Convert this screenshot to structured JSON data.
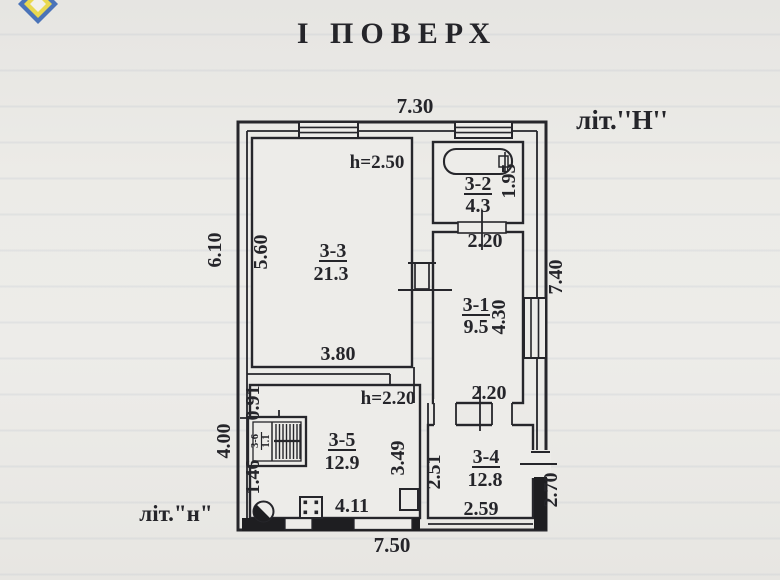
{
  "title": "І  ПОВЕРХ",
  "labels": {
    "building_top": "літ.''Н''",
    "building_bottom": "літ.\"н\""
  },
  "rooms": {
    "r33": {
      "id": "3-3",
      "area": "21.3",
      "ceiling": "h=2.50"
    },
    "r32": {
      "id": "3-2",
      "area": "4.3"
    },
    "r31": {
      "id": "3-1",
      "area": "9.5"
    },
    "r35": {
      "id": "3-5",
      "area": "12.9",
      "ceiling": "h=2.20"
    },
    "r34": {
      "id": "3-4",
      "area": "12.8"
    },
    "r36": {
      "id": "3-6",
      "area": "1.1"
    }
  },
  "dims": {
    "top_width": "7.30",
    "bottom_width": "7.50",
    "left_upper": "6.10",
    "left_lower": "4.00",
    "right_full": "7.40",
    "right_lower": "2.70",
    "r33_left": "5.60",
    "r33_bottom": "3.80",
    "r32_right": "1.95",
    "r32_bottom": "2.20",
    "r31_right": "4.30",
    "r31_bottom": "2.20",
    "r35_stair_top": "0.91",
    "r35_stair_bottom": "1.46",
    "r35_right": "3.49",
    "r35_bottom": "4.11",
    "r34_left": "2.51",
    "r34_bottom": "2.59"
  }
}
